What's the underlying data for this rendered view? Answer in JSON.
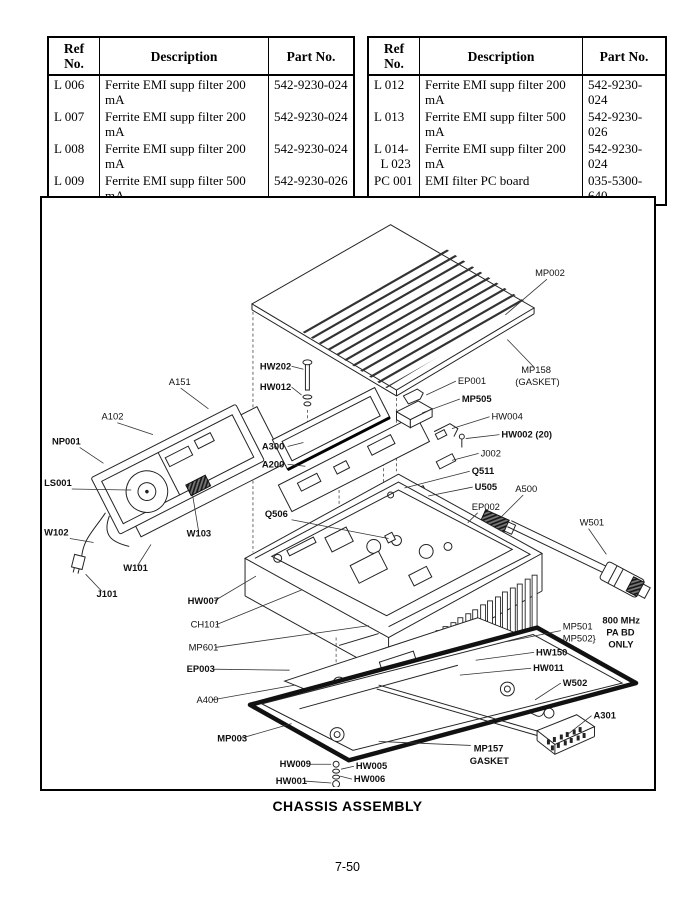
{
  "page_number": "7-50",
  "tables": {
    "left": {
      "headers": [
        "Ref No.",
        "Description",
        "Part No."
      ],
      "rows": [
        {
          "ref": "L 006",
          "desc": "Ferrite EMI supp filter 200 mA",
          "part": "542-9230-024"
        },
        {
          "ref": "L 007",
          "desc": "Ferrite EMI supp filter 200 mA",
          "part": "542-9230-024"
        },
        {
          "ref": "L 008",
          "desc": "Ferrite EMI supp filter 200 mA",
          "part": "542-9230-024"
        },
        {
          "ref": "L 009",
          "desc": "Ferrite EMI supp filter 500 mA",
          "part": "542-9230-026"
        },
        {
          "ref": "L 010",
          "desc": "Ferrite EMI supp filter 200 mA",
          "part": "542-9230-024"
        },
        {
          "ref": "L 011",
          "desc": "Ferrite EMI supp filter 500 mA",
          "part": "542-9230-026"
        }
      ]
    },
    "right": {
      "headers": [
        "Ref No.",
        "Description",
        "Part No."
      ],
      "rows": [
        {
          "ref": "L 012",
          "desc": "Ferrite EMI supp filter 200 mA",
          "part": "542-9230-024"
        },
        {
          "ref": "L 013",
          "desc": "Ferrite EMI supp filter 500 mA",
          "part": "542-9230-026"
        },
        {
          "ref": "L 014-\n  L 023",
          "desc": "Ferrite EMI supp filter 200 mA",
          "part": "542-9230-024"
        },
        {
          "ref": "PC 001",
          "desc": "EMI filter PC board",
          "part": "035-5300-640"
        }
      ]
    }
  },
  "diagram": {
    "title": "CHASSIS ASSEMBLY",
    "labels": {
      "mp002": "MP002",
      "mp158_1": "MP158",
      "mp158_2": "(GASKET)",
      "hw202": "HW202",
      "hw012": "HW012",
      "ep001": "EP001",
      "mp505": "MP505",
      "a300": "A300",
      "hw004": "HW004",
      "hw002": "HW002 (20)",
      "a200": "A200",
      "j002": "J002",
      "q511": "Q511",
      "u505": "U505",
      "ep002": "EP002",
      "a500": "A500",
      "a151": "A151",
      "a102": "A102",
      "np001": "NP001",
      "ls001": "LS001",
      "q506": "Q506",
      "w501": "W501",
      "w102": "W102",
      "w103": "W103",
      "w101": "W101",
      "j101": "J101",
      "hw007": "HW007",
      "ch101": "CH101",
      "mp601": "MP601",
      "mp501": "MP501",
      "mp502": "MP502",
      "pa_brace": "}",
      "pa_note_1": "800 MHz",
      "pa_note_2": "PA BD",
      "pa_note_3": "ONLY",
      "hw150": "HW150",
      "hw011": "HW011",
      "ep003": "EP003",
      "w502": "W502",
      "a400": "A400",
      "a301": "A301",
      "mp003": "MP003",
      "mp157_1": "MP157",
      "mp157_2": "GASKET",
      "hw009": "HW009",
      "hw005": "HW005",
      "hw006": "HW006",
      "hw001": "HW001"
    }
  }
}
